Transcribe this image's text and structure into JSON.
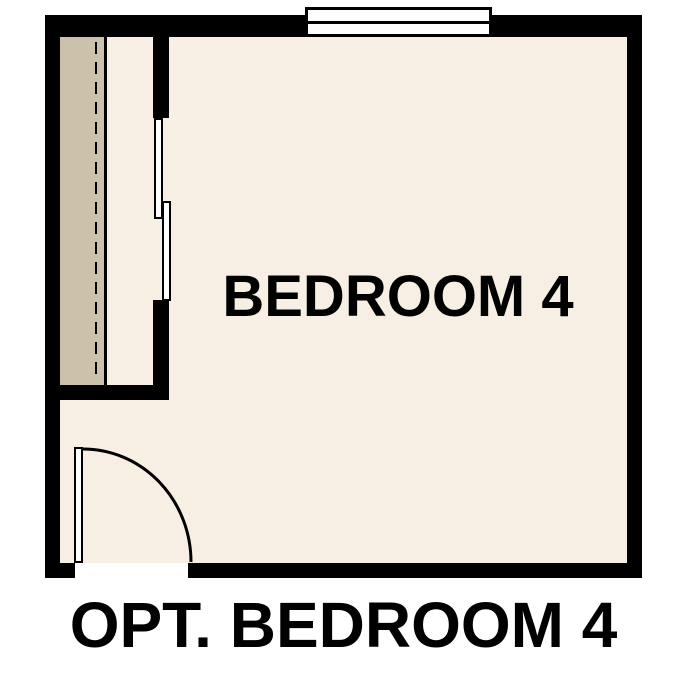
{
  "diagram": {
    "type": "floor-plan",
    "room_label": "BEDROOM 4",
    "caption": "OPT. BEDROOM 4",
    "symbols": [
      "window-symbol",
      "bypass-closet-door-panels",
      "closet-rod-dashed-line",
      "closet-shelf-area",
      "hinged-door-with-swing-arc"
    ],
    "colors": {
      "background": "#ffffff",
      "wall": "#000000",
      "floor": "#f7efe3",
      "closet_shelf": "#ccc2ac",
      "fixture": "#ffffff",
      "text": "#000000"
    }
  }
}
